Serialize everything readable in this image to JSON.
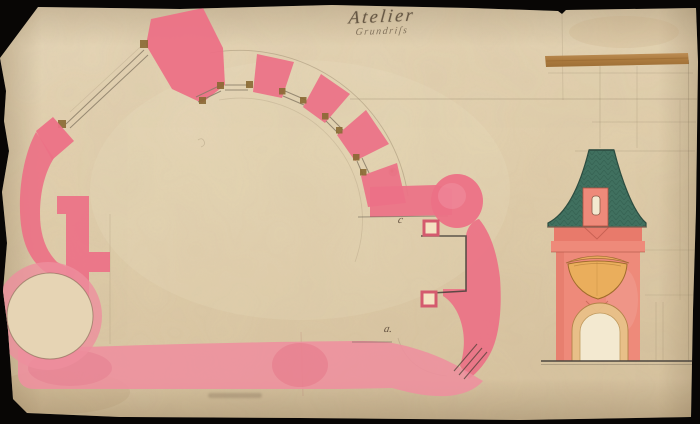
{
  "artwork": {
    "title": "Atelier",
    "subtitle": "Grundriſs",
    "plan_labels": {
      "upper": "c",
      "lower": "a."
    }
  },
  "colors": {
    "background": "#080605",
    "paper": "#e2d0b0",
    "plan_pink": "#ec7186",
    "plan_pink_deep": "#e66079",
    "plan_pink_light": "#ee8f9e",
    "elevation_salmon": "#ee8a7a",
    "elevation_salmon_deep": "#e87a6b",
    "roof_green": "#40705f",
    "roof_green_dark": "#2c4c40",
    "ornament_orange": "#eaae5c",
    "archivolt_tan": "#e8c289",
    "opening_cream": "#f3e9d0",
    "timber_brown": "#8a6a33",
    "pencil_gray": "#6b5c44",
    "ink_dark": "#44403a",
    "tape_brown": "#ad7a42"
  }
}
